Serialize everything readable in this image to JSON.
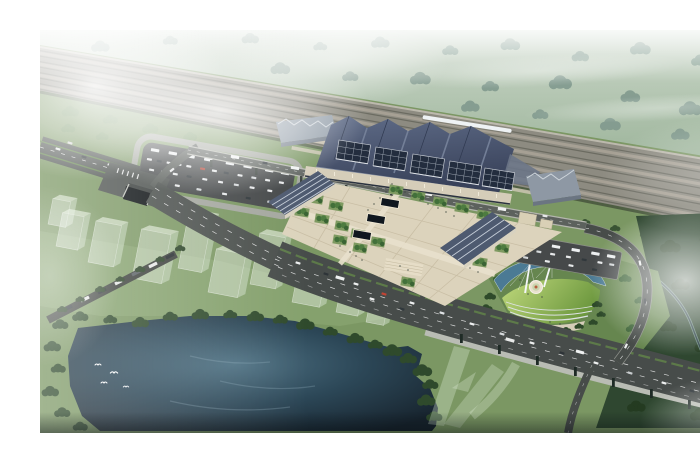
{
  "scene": {
    "title": "Aerial rendering of a riverside high-speed railway station complex",
    "description": "Bird's-eye architectural visualization: misty forest and multi-track railway corridor at top with a white high-speed train, a station hall with dark sawtooth roof and gridded platform canopies, central paved plaza with tree planters and skylights, bus and car parking lots, a diagonal multi-lane boulevard with tunnel portal and elevated bridge, a circular landmark pavilion with green fan roof, crescent pond, two white masts and an emblem plaza, translucent ghost massing blocks of planned development, a dark lake with flying birds, and a winding river in dark forest under white mist.",
    "type": "architectural-aerial-rendering",
    "regions": [
      {
        "name": "north-forest",
        "label": "Misty forest belt"
      },
      {
        "name": "railway-corridor",
        "label": "Multi-track railway corridor",
        "track_count": 8
      },
      {
        "name": "high-speed-train",
        "label": "White high-speed train"
      },
      {
        "name": "railway-station",
        "label": "Station hall with sawtooth roof and canopies"
      },
      {
        "name": "central-plaza",
        "label": "Paved station plaza",
        "skylight_count": 3
      },
      {
        "name": "warehouses",
        "label": "Ribbed-roof side halls",
        "count": 2
      },
      {
        "name": "west-parking-lot",
        "label": "Bus and car park with loop road"
      },
      {
        "name": "east-parking-lot",
        "label": "East coach park"
      },
      {
        "name": "main-boulevard",
        "label": "Diagonal multi-lane boulevard with green median"
      },
      {
        "name": "tunnel-portal",
        "label": "Underpass portal"
      },
      {
        "name": "highway-bridge",
        "label": "Elevated bridge section with piers"
      },
      {
        "name": "slip-road",
        "label": "Curved slip road"
      },
      {
        "name": "landmark-park",
        "label": "Circular landmark: green fan-roof pavilion, crescent pond, 2 masts, emblem plaza"
      },
      {
        "name": "ghost-development",
        "label": "Translucent planned building massing",
        "count": 10
      },
      {
        "name": "lake",
        "label": "Dark lake with birds",
        "bird_count": 4
      },
      {
        "name": "river",
        "label": "Winding river in dark east forest"
      },
      {
        "name": "mist-overlay",
        "label": "White mist blooms"
      }
    ]
  },
  "palette": {
    "ground": "#7b9763",
    "forest-pale": "#b9c9b9",
    "tree-pale": "#8aa397",
    "rail-bed": "#8d8b81",
    "rail-line": "#6b6b61",
    "train": "#eef2f4",
    "roof-dark": "#49546d",
    "canopy": "#232d3e",
    "annex": "#95a0ab",
    "plaza": "#dcd3bc",
    "plaza-line": "#c6bba1",
    "tan": "#d5cdb9",
    "asphalt": "#4a4f4c",
    "lot": "#46494a",
    "median": "#5f8049",
    "lake-deep": "#17232d",
    "pond": "#4b7a94",
    "fan-hi": "#c0d97c",
    "fan-lo": "#6d983f",
    "tree-dark": "#2f4a2c",
    "forest-east": "#2f4730",
    "vehicle": "#eceff0"
  }
}
